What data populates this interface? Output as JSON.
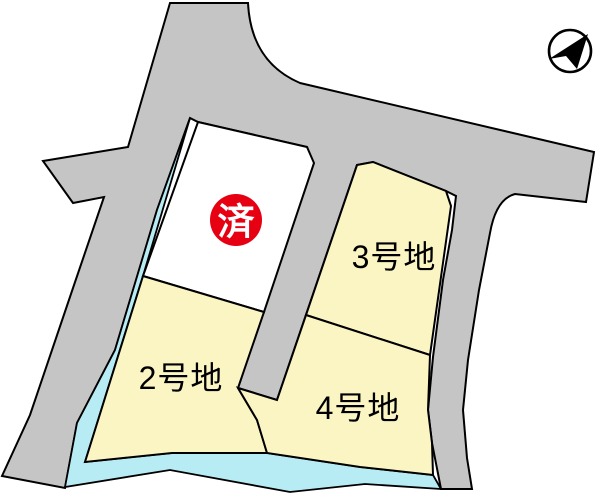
{
  "map": {
    "type": "residential-lot-plan",
    "lots": {
      "lot1": {
        "status_badge": "済",
        "status_meaning": "sold"
      },
      "lot2": {
        "label": "2号地"
      },
      "lot3": {
        "label": "3号地"
      },
      "lot4": {
        "label": "4号地"
      }
    },
    "compass": {
      "direction": "north-east-arrow"
    }
  },
  "colors": {
    "background": "#ffffff",
    "road": "#c5c5c5",
    "water": "#b8ecf5",
    "lot": "#fbf5c4",
    "sold_lot": "#ffffff",
    "sold_badge": "#e60012",
    "badge_text": "#ffffff",
    "label": "#000000",
    "outline": "#000000"
  }
}
